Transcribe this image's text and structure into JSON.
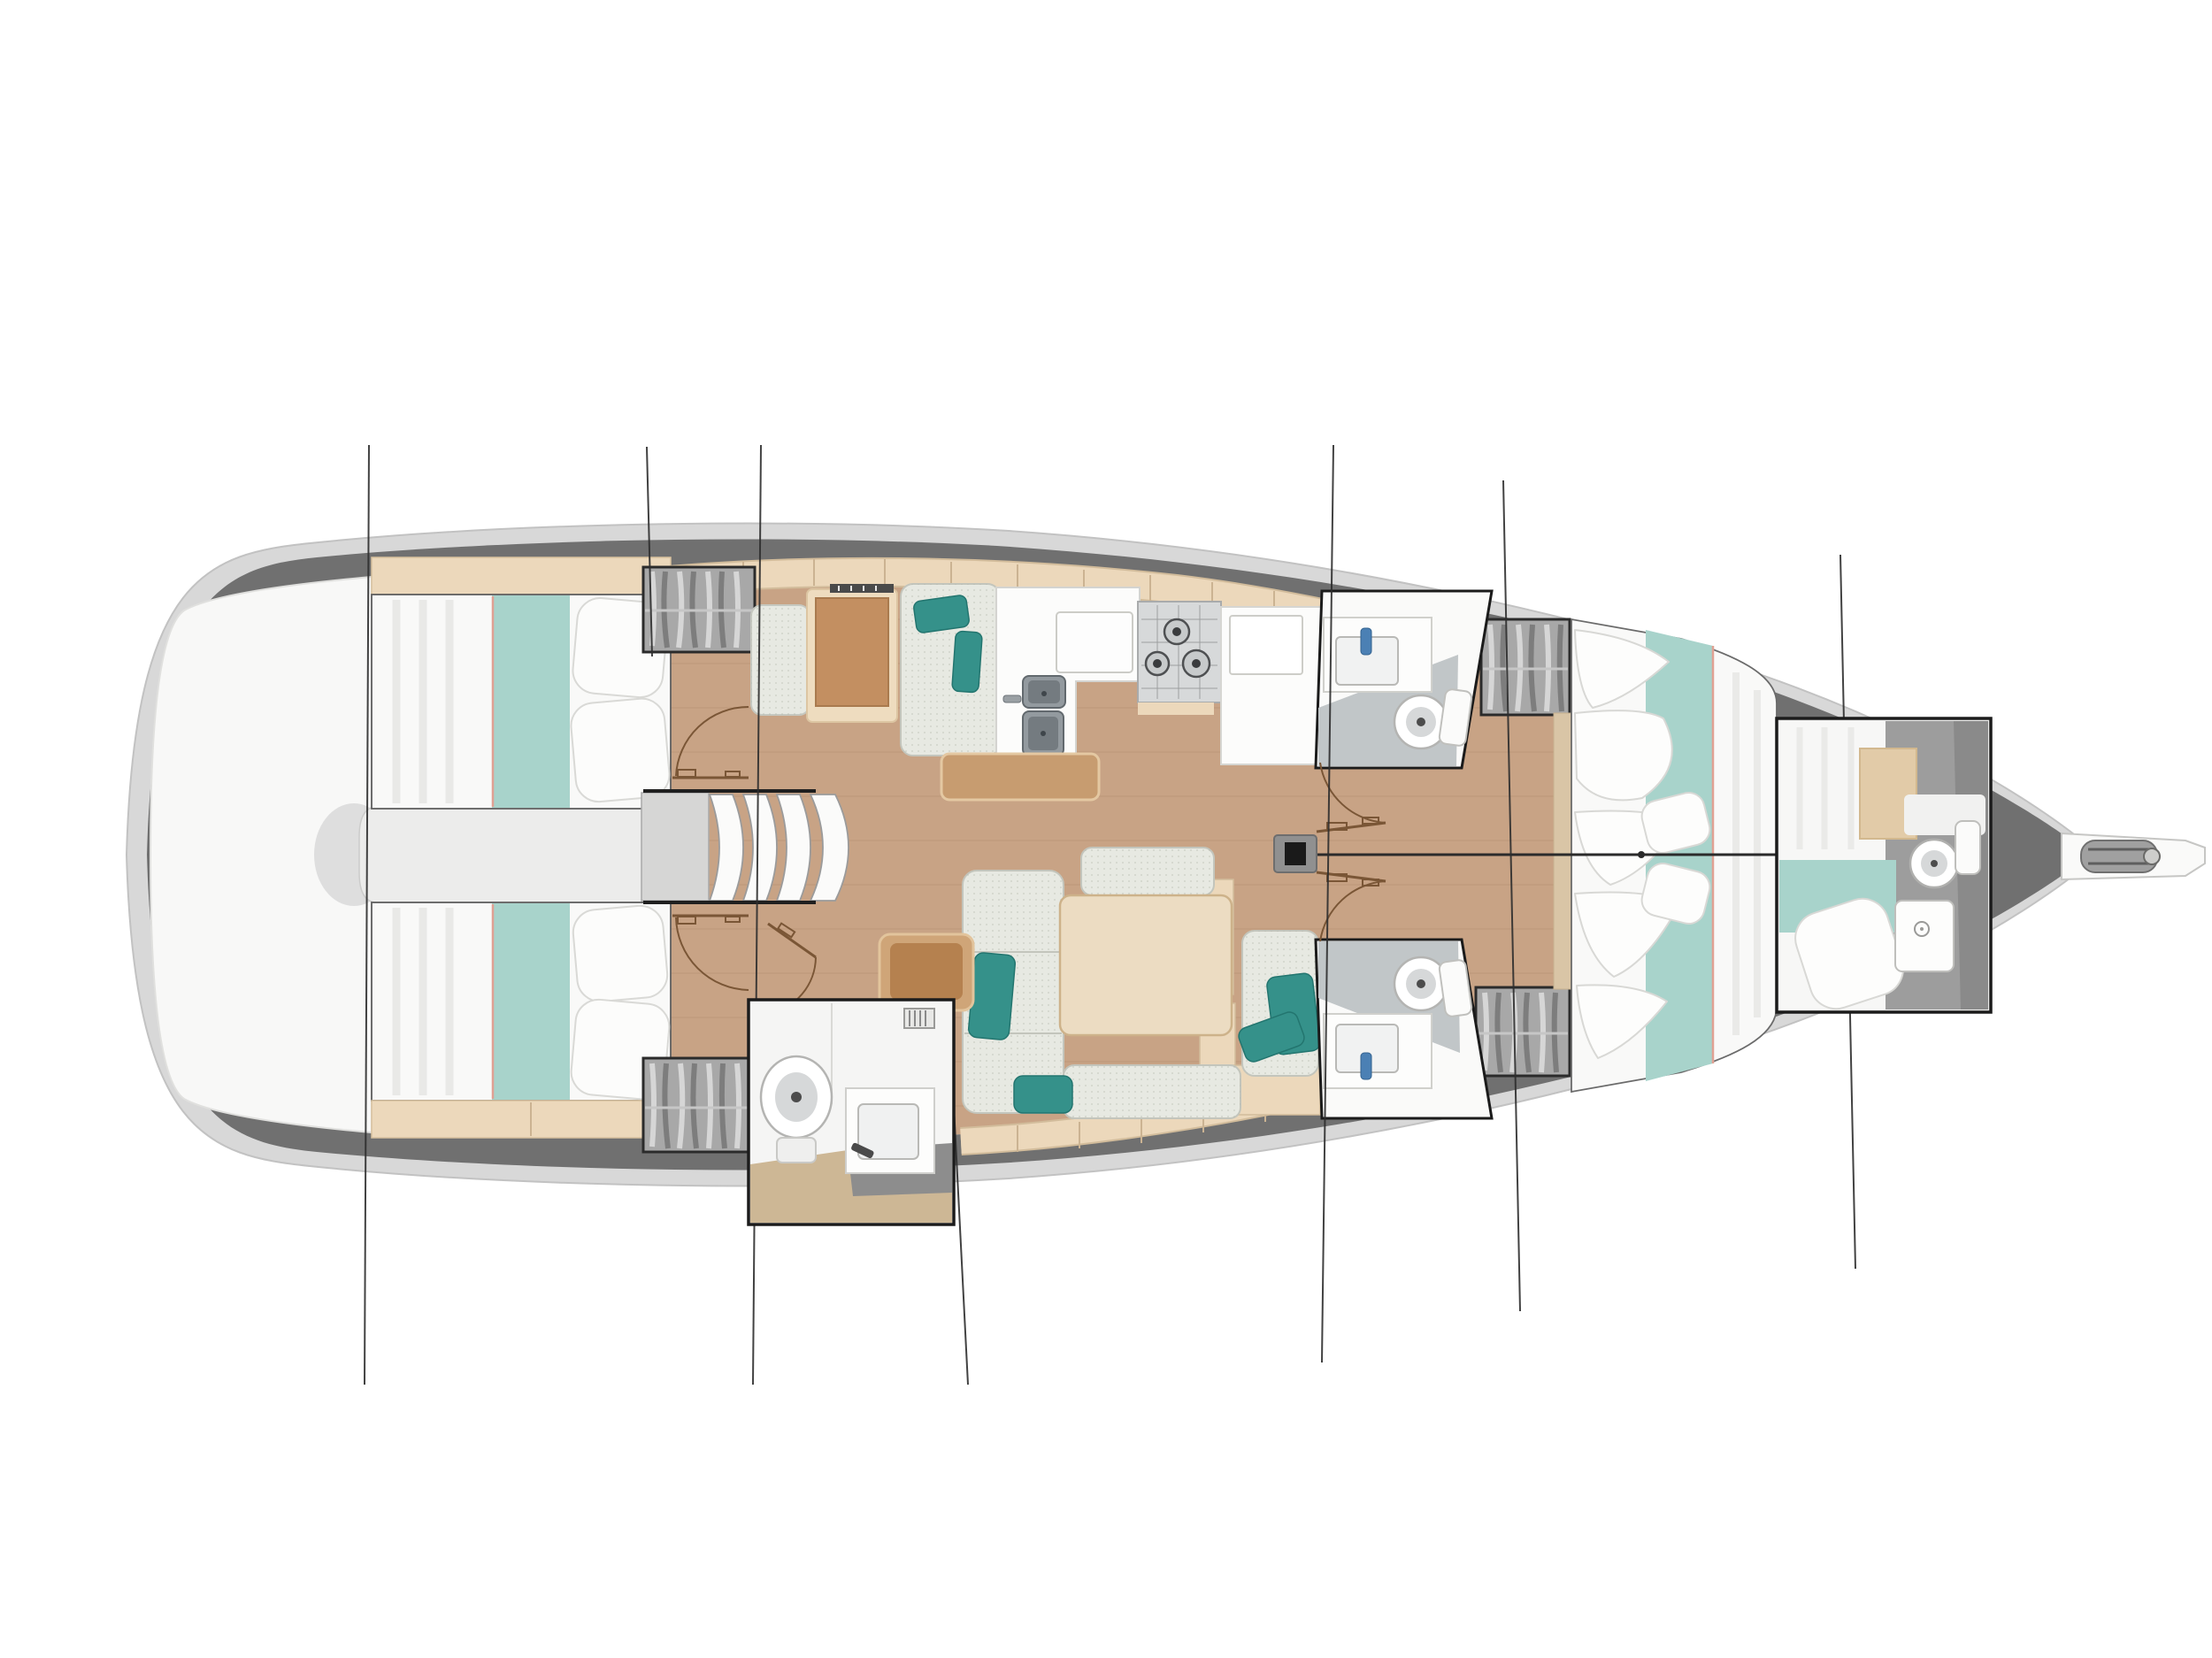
{
  "page": {
    "background": "#ffffff"
  },
  "palette": {
    "hull_outer": "#d8d8d8",
    "hull_walkway": "#707070",
    "hull_interior": "#f2f1ef",
    "platform_white": "#f8f8f7",
    "engine_gray": "#ececeb",
    "floor_wood": "#c8a385",
    "locker_beige": "#ecd8bb",
    "locker_seam": "#cbb392",
    "bed_white": "#f9f9f8",
    "bed_runner": "#a8d3cb",
    "runner_piping": "#e0a193",
    "pillow_white": "#fcfcfb",
    "cushion_gray": "#e7e9e2",
    "cushion_edge": "#c3c5bc",
    "pillow_teal": "#35918a",
    "desk_wood": "#c38f61",
    "desk_frame": "#eedcbf",
    "table_wood": "#ecdcc2",
    "bar_wood": "#c79c70",
    "pouf_brown": "#b5814f",
    "counter_white": "#fcfcfb",
    "sink_steel": "#939a9f",
    "stove_panel": "#d7d9da",
    "bath_floor": "#c1c6c8",
    "fixture_white": "#ffffff",
    "faucet_blue": "#4b80b4",
    "wardrobe_gray": "#a8a8a8",
    "wardrobe_border": "#2b2b2b",
    "inset_border": "#1b1b1b",
    "bow_gray": "#9d9d9d",
    "mast_black": "#1a1a1a",
    "step_white": "#fbfbfa",
    "door_line": "#7a5636",
    "section_line": "#2e2e2e",
    "centerline": "#2b2b2b"
  },
  "diagram": {
    "type": "yacht-interior-floorplan",
    "orientation": "bow-right",
    "rooms": [
      {
        "id": "swim-platform",
        "side": "stern"
      },
      {
        "id": "aft-cabin-port",
        "fixtures": [
          "double-berth",
          "teal-runner",
          "pillows",
          "headboard-locker"
        ]
      },
      {
        "id": "aft-cabin-starboard",
        "fixtures": [
          "double-berth",
          "teal-runner",
          "pillows",
          "footboard-locker"
        ]
      },
      {
        "id": "engine-space",
        "fixtures": []
      },
      {
        "id": "companionway",
        "fixtures": [
          "steps-4",
          "landing"
        ]
      },
      {
        "id": "nav-station",
        "fixtures": [
          "chart-table",
          "seat",
          "instruments"
        ]
      },
      {
        "id": "galley",
        "fixtures": [
          "l-counter",
          "double-sink",
          "faucet",
          "stove-3-burner",
          "fridge-counter",
          "bar-shelf"
        ]
      },
      {
        "id": "salon",
        "fixtures": [
          "u-sofa",
          "dining-table",
          "teal-pillows",
          "pouf"
        ]
      },
      {
        "id": "aft-head-inset",
        "fixtures": [
          "toilet",
          "sink",
          "vent-grille"
        ]
      },
      {
        "id": "head-forward-port",
        "fixtures": [
          "toilet",
          "sink",
          "faucet"
        ]
      },
      {
        "id": "head-forward-starboard",
        "fixtures": [
          "toilet",
          "sink",
          "faucet"
        ]
      },
      {
        "id": "forward-cabin",
        "fixtures": [
          "v-berth",
          "teal-runner",
          "pillows"
        ]
      },
      {
        "id": "bow-ensuite-inset",
        "fixtures": [
          "berth-section",
          "teal-runner",
          "pillow",
          "toilet",
          "shower-pan",
          "wood-panel"
        ]
      },
      {
        "id": "wardrobes",
        "count": 4
      },
      {
        "id": "mast",
        "count": 1
      },
      {
        "id": "bowsprit",
        "fixtures": [
          "anchor-roller"
        ]
      }
    ],
    "section_lines": [
      [
        417,
        503,
        412,
        1565
      ],
      [
        731,
        505,
        737,
        742
      ],
      [
        860,
        503,
        851,
        1565
      ],
      [
        1072,
        1132,
        1094,
        1565
      ],
      [
        1507,
        503,
        1494,
        1540
      ],
      [
        1699,
        543,
        1718,
        1482
      ],
      [
        2080,
        627,
        2097,
        1434
      ]
    ]
  }
}
